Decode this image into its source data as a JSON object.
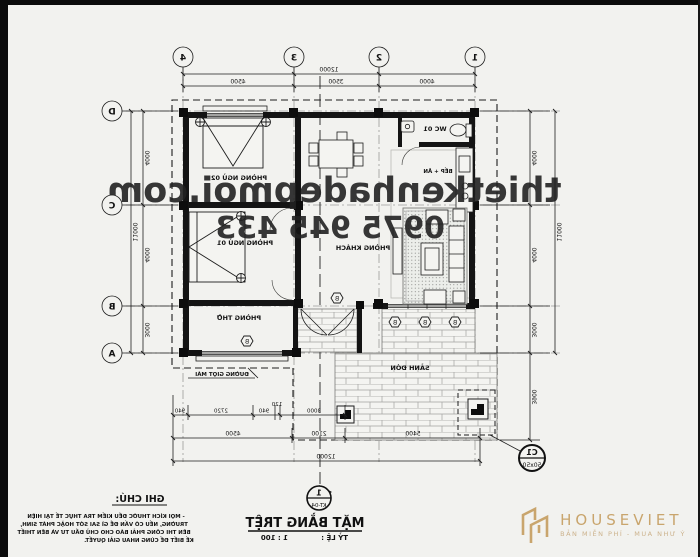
{
  "watermark": {
    "line1": "thietkenhadepmoi.com",
    "line2": "0975 945 433"
  },
  "grid": {
    "cols": [
      "1",
      "2",
      "3",
      "4"
    ],
    "rows": [
      "D",
      "C",
      "B",
      "A"
    ]
  },
  "rooms": {
    "wc": "WC 01",
    "kitchen": "BẾP + ĂN",
    "living": "PHÒNG KHÁCH",
    "bed2": "PHÒNG NGỦ 02",
    "bed1": "PHÒNG NGỦ 01",
    "worship": "PHÒNG THỜ",
    "terrace": "SẢNH ĐÓN"
  },
  "callouts": {
    "roofline": "ĐƯỜNG GIỌT MÁI",
    "detail_top": "C1",
    "detail_bottom": "50x50",
    "section_top": "1",
    "section_bottom": "KT-04",
    "tag": "B"
  },
  "dims": {
    "top_overall": "12000",
    "top_chain": [
      "4000",
      "3500",
      "4500"
    ],
    "right_chain": [
      "4000",
      "4000",
      "3000"
    ],
    "right_overall": "11000",
    "left_chain": [
      "4000",
      "4000",
      "3000",
      "3900"
    ],
    "left_overall": "11000",
    "bottom_chain1": [
      "3000",
      "120",
      "940",
      "2720",
      "940"
    ],
    "bottom_chain2": [
      "5400",
      "2100",
      "4500"
    ],
    "bottom_overall": "12000"
  },
  "title": {
    "name": "MẶT BẰNG TRỆT",
    "scale_label": "TỶ LỆ :",
    "scale_value": "1 : 100"
  },
  "notes": {
    "heading": "GHI CHÚ:",
    "line1": "- MỌI KÍCH THƯỚC ĐỀU KIỂM TRA THỰC TẾ TẠI HIỆN",
    "line2": "TRƯỜNG, NẾU CÓ VẤN ĐỀ GÌ SAI SÓT HOẶC PHÁT SINH,",
    "line3": "BÊN THI CÔNG PHẢI BÁO CHO CHỦ ĐẦU TƯ VÀ BÊN THIẾT",
    "line4": "KẾ BIẾT ĐỂ CÙNG NHAU GIẢI QUYẾT."
  },
  "logo": {
    "name": "HOUSEVIET",
    "tagline": "BẢN MIỄN PHÍ - MUA NHƯ Ý"
  },
  "colors": {
    "ink": "#1f1f1f",
    "paper": "#f2f2ef",
    "logo_gold": "#c9a56d"
  }
}
